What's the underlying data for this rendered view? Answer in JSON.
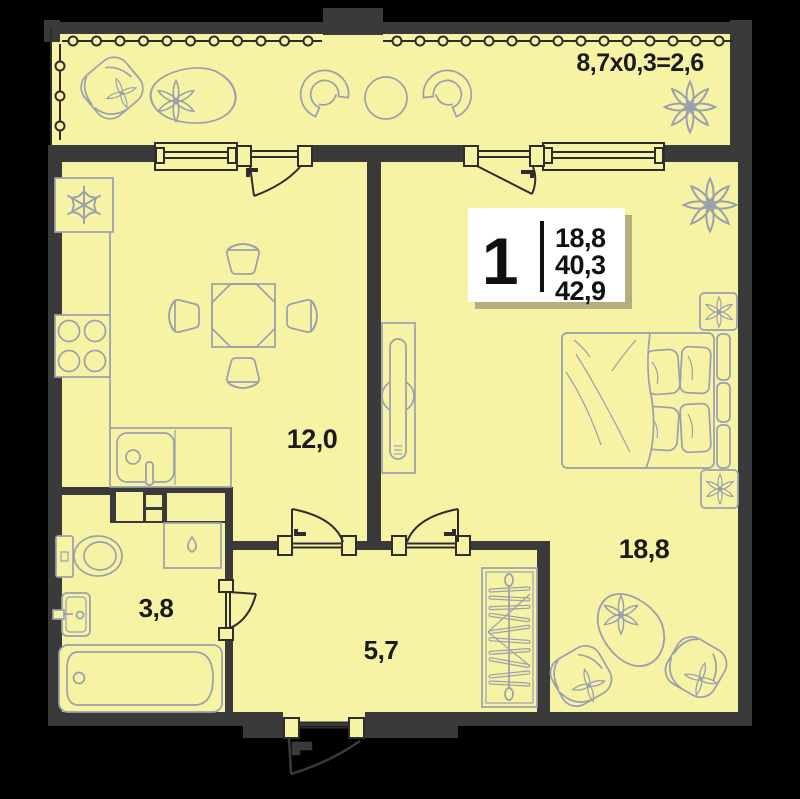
{
  "floorplan": {
    "balcony": {
      "dimension_label": "8,7x0,3=2,6"
    },
    "unit_card": {
      "room_count": "1",
      "living_area": "18,8",
      "floor_area": "40,3",
      "total_area": "42,9"
    },
    "labels": {
      "kitchen_living": "12,0",
      "bedroom": "18,8",
      "bathroom": "3,8",
      "hallway": "5,7"
    },
    "icons": [
      "fridge-icon",
      "stove-icon",
      "kitchen-sink-icon",
      "dining-table-icon",
      "chair-icon",
      "toilet-icon",
      "washing-machine-icon",
      "bath-sink-icon",
      "bathtub-icon",
      "wardrobe-icon",
      "bed-icon",
      "nightstand-icon",
      "tv-stand-icon",
      "armchair-icon",
      "pouf-icon",
      "plant-icon",
      "snowflake-icon",
      "window-icon",
      "door-swing-icon",
      "glazing-icon"
    ],
    "colors": {
      "background": "#000000",
      "walls": "#3a3a3a",
      "floor": "#f7f3a4",
      "furniture_outline": "#9aa0ad",
      "label_text": "#1b1b1b",
      "card_background": "#ffffff",
      "card_shadow": "#b6ae7e"
    }
  }
}
